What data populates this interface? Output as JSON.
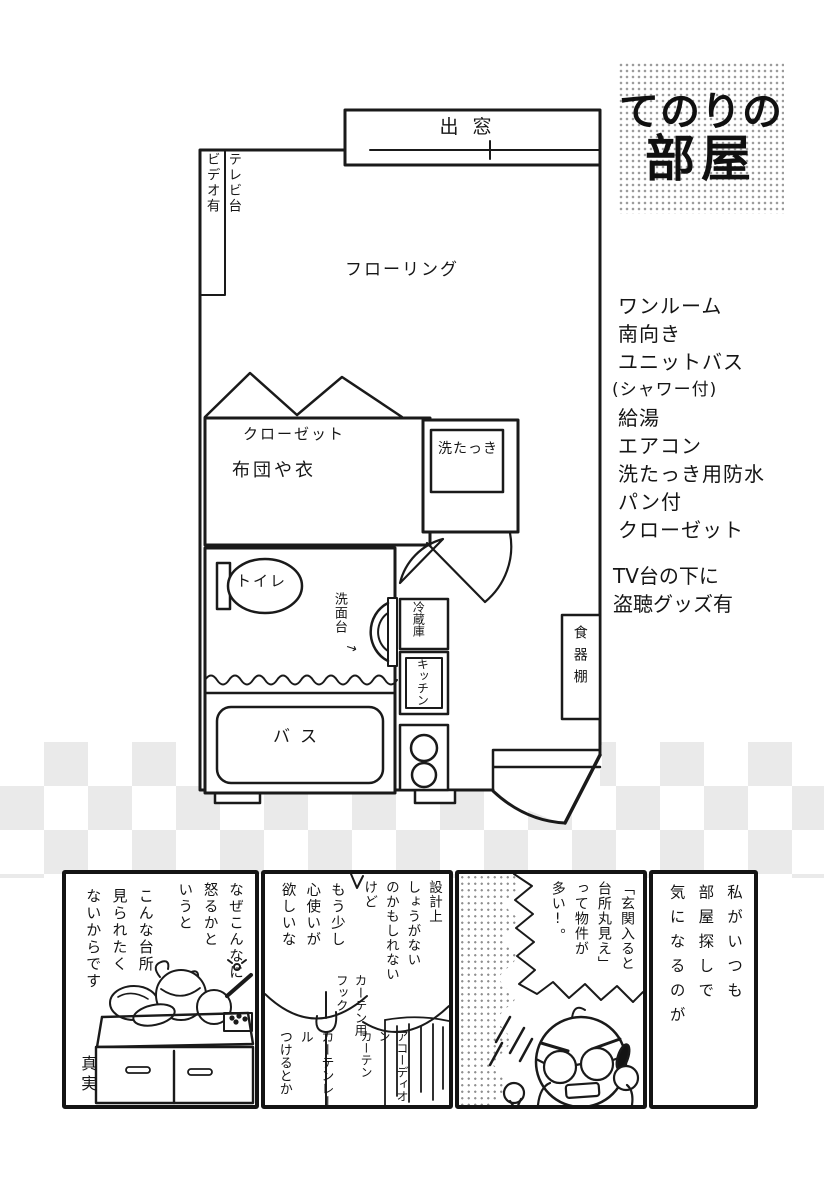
{
  "title": {
    "line1": "てのりの",
    "line2": "部屋"
  },
  "plan": {
    "bay_window": "出窓",
    "tv_stand": "テレビ台\nビデオ有",
    "flooring": "フローリング",
    "closet": "クローゼット",
    "closet_note": "布団や衣",
    "washer": "洗たっき",
    "toilet": "トイレ",
    "washstand": "洗面台",
    "washstand_arrow": "→",
    "fridge": "冷蔵庫",
    "kitchen": "キッチン",
    "bath": "バス",
    "cupboard": "食器棚"
  },
  "features": {
    "items": [
      "ワンルーム",
      "南向き",
      "ユニットバス",
      "(シャワー付)",
      "給湯",
      "エアコン",
      "洗たっき用防水",
      "パン付",
      "クローゼット"
    ]
  },
  "note": {
    "line1": "TV台の下に",
    "line2": "盗聴グッズ有"
  },
  "comic": {
    "intro": "私がいつも\n部屋探しで\n気になるのが",
    "speech_main": "「玄関入ると\n台所丸見え」\nって物件が\n多い!。",
    "bubble_design": "設計上\nしょうがない\nのかもしれない\nけど",
    "bubble_wish": "もう少し\n心使いが\n欲しいな",
    "label_hook": "カーテン用\nフック",
    "label_accordion": "アコーディオン\nカーテン",
    "label_rail": "カーテンレール\nつけるとか",
    "why": "なぜこんなに\n怒るかと\nいうと",
    "reason": "こんな台所\n見られたく\nないからです",
    "caption_truth": "真実"
  },
  "colors": {
    "ink": "#1a1a1a",
    "paper": "#ffffff",
    "checker": "#dedede"
  }
}
